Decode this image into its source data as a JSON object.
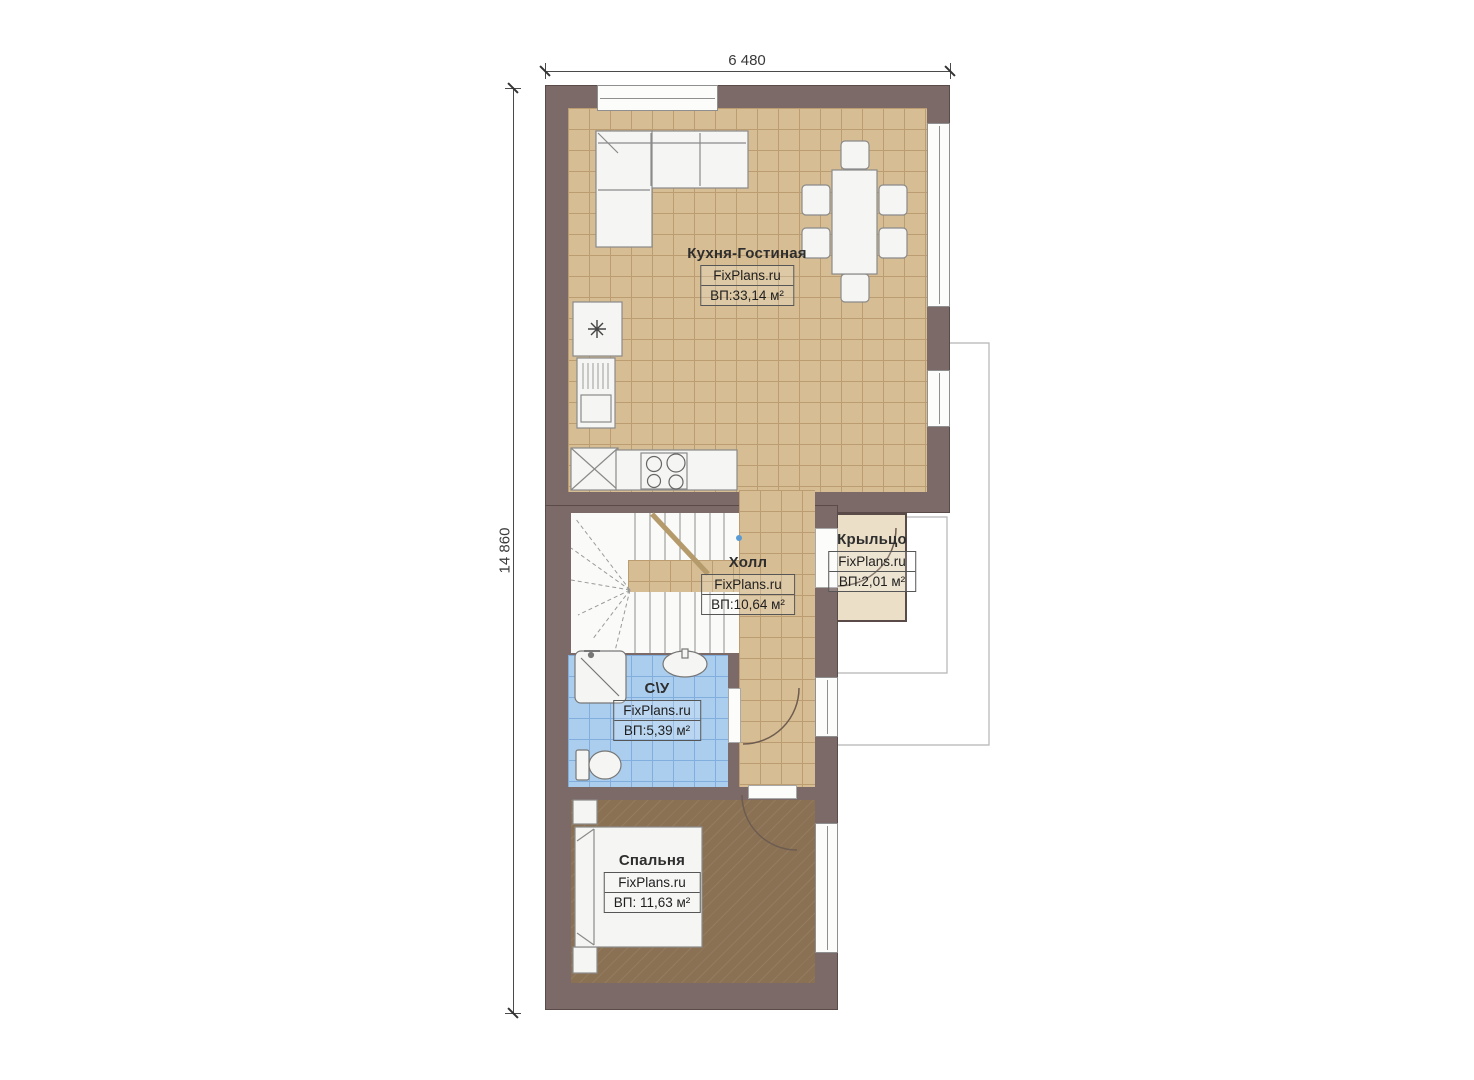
{
  "dimensions": {
    "width_label": "6 480",
    "height_label": "14 860"
  },
  "rooms": [
    {
      "key": "kitchen-living",
      "name": "Кухня-Гостиная",
      "brand": "FixPlans.ru",
      "area": "ВП:33,14 м²"
    },
    {
      "key": "hall",
      "name": "Холл",
      "brand": "FixPlans.ru",
      "area": "ВП:10,64 м²"
    },
    {
      "key": "porch",
      "name": "Крыльцо",
      "brand": "FixPlans.ru",
      "area": "ВП:2,01 м²"
    },
    {
      "key": "wc",
      "name": "С\\У",
      "brand": "FixPlans.ru",
      "area": "ВП:5,39 м²"
    },
    {
      "key": "bedroom",
      "name": "Спальня",
      "brand": "FixPlans.ru",
      "area": "ВП: 11,63 м²"
    }
  ],
  "colors": {
    "wall": "#7c6a68",
    "wall-edge": "#5a4b49",
    "tile-floor": "#d7bd93",
    "tile-grid": "#bb9d71",
    "wet-floor": "#abceee",
    "wet-grid": "#82aede",
    "wood-floor": "#8b7154",
    "porch-floor": "#ebdfc8",
    "fixture-fill": "#f5f5f3",
    "fixture-line": "#8a8a8a"
  }
}
